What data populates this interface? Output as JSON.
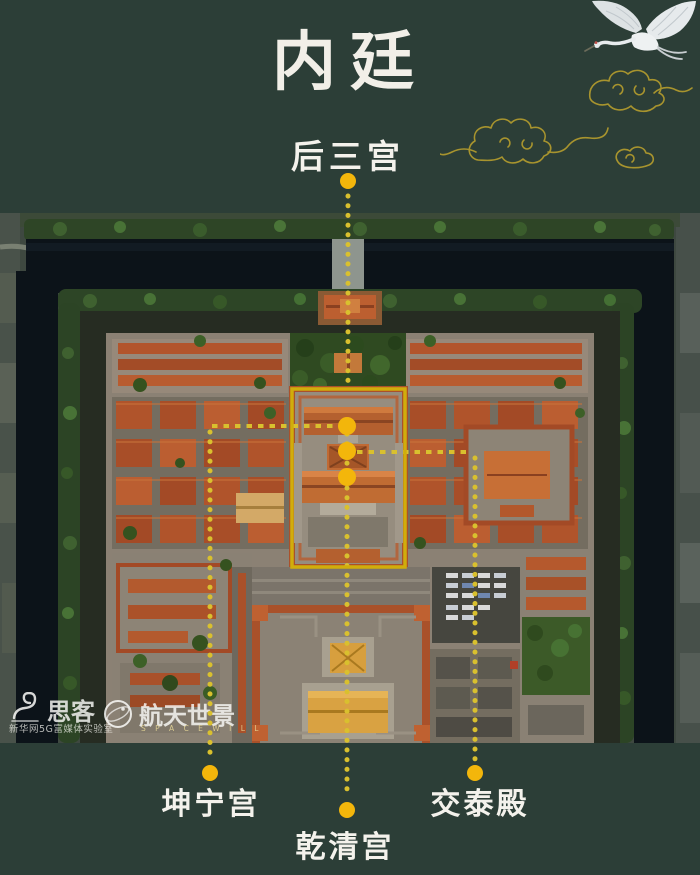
{
  "page": {
    "title": "内廷",
    "background_color": "#2c3e37"
  },
  "labels": {
    "top": "后三宫",
    "bottom_left": "坤宁宫",
    "bottom_center": "乾清宫",
    "bottom_right": "交泰殿"
  },
  "colors": {
    "accent_dot": "#f3b60b",
    "dotted_line": "#d9c02e",
    "highlight_box": "#d1ad0b",
    "cloud_gold": "#a8942e",
    "crane_white": "#e3e7e9",
    "moat_water": "#0c1319"
  },
  "watermark": {
    "sike": "思客",
    "sike_sub": "新华网5G富媒体实验室",
    "spaceview": "航天世景",
    "spaceview_sub": "S P A C E W I L L"
  }
}
